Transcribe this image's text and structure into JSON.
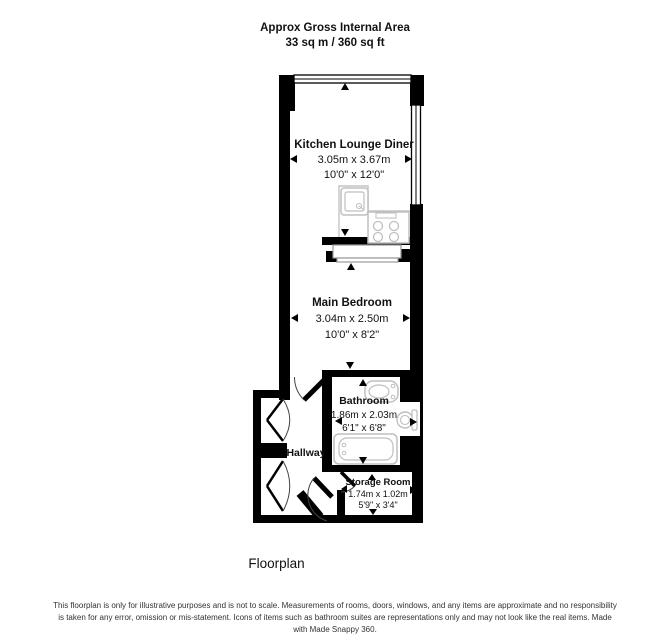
{
  "header": {
    "title": "Approx Gross Internal Area",
    "area": "33 sq m / 360 sq ft"
  },
  "rooms": [
    {
      "name": "Kitchen Lounge Diner",
      "metric": "3.05m x 3.67m",
      "imperial": "10'0\" x 12'0\""
    },
    {
      "name": "Main Bedroom",
      "metric": "3.04m x 2.50m",
      "imperial": "10'0\" x 8'2\""
    },
    {
      "name": "Bathroom",
      "metric": "1.86m x 2.03m",
      "imperial": "6'1\" x 6'8\""
    },
    {
      "name": "Hallway"
    },
    {
      "name": "Storage Room",
      "metric": "1.74m x 1.02m",
      "imperial": "5'9\" x 3'4\""
    }
  ],
  "caption": "Floorplan",
  "footer": {
    "disclaimer": "This floorplan is only for illustrative purposes and is not to scale. Measurements of rooms, doors, windows, and any items are approximate and no responsibility is taken for any error, omission or mis-statement. Icons of items such as bathroom suites are representations only and may not look like the real items. Made with Made Snappy 360."
  },
  "colors": {
    "wall": "#000000",
    "fixture_stroke": "#bfbfbf",
    "text": "#111111"
  }
}
